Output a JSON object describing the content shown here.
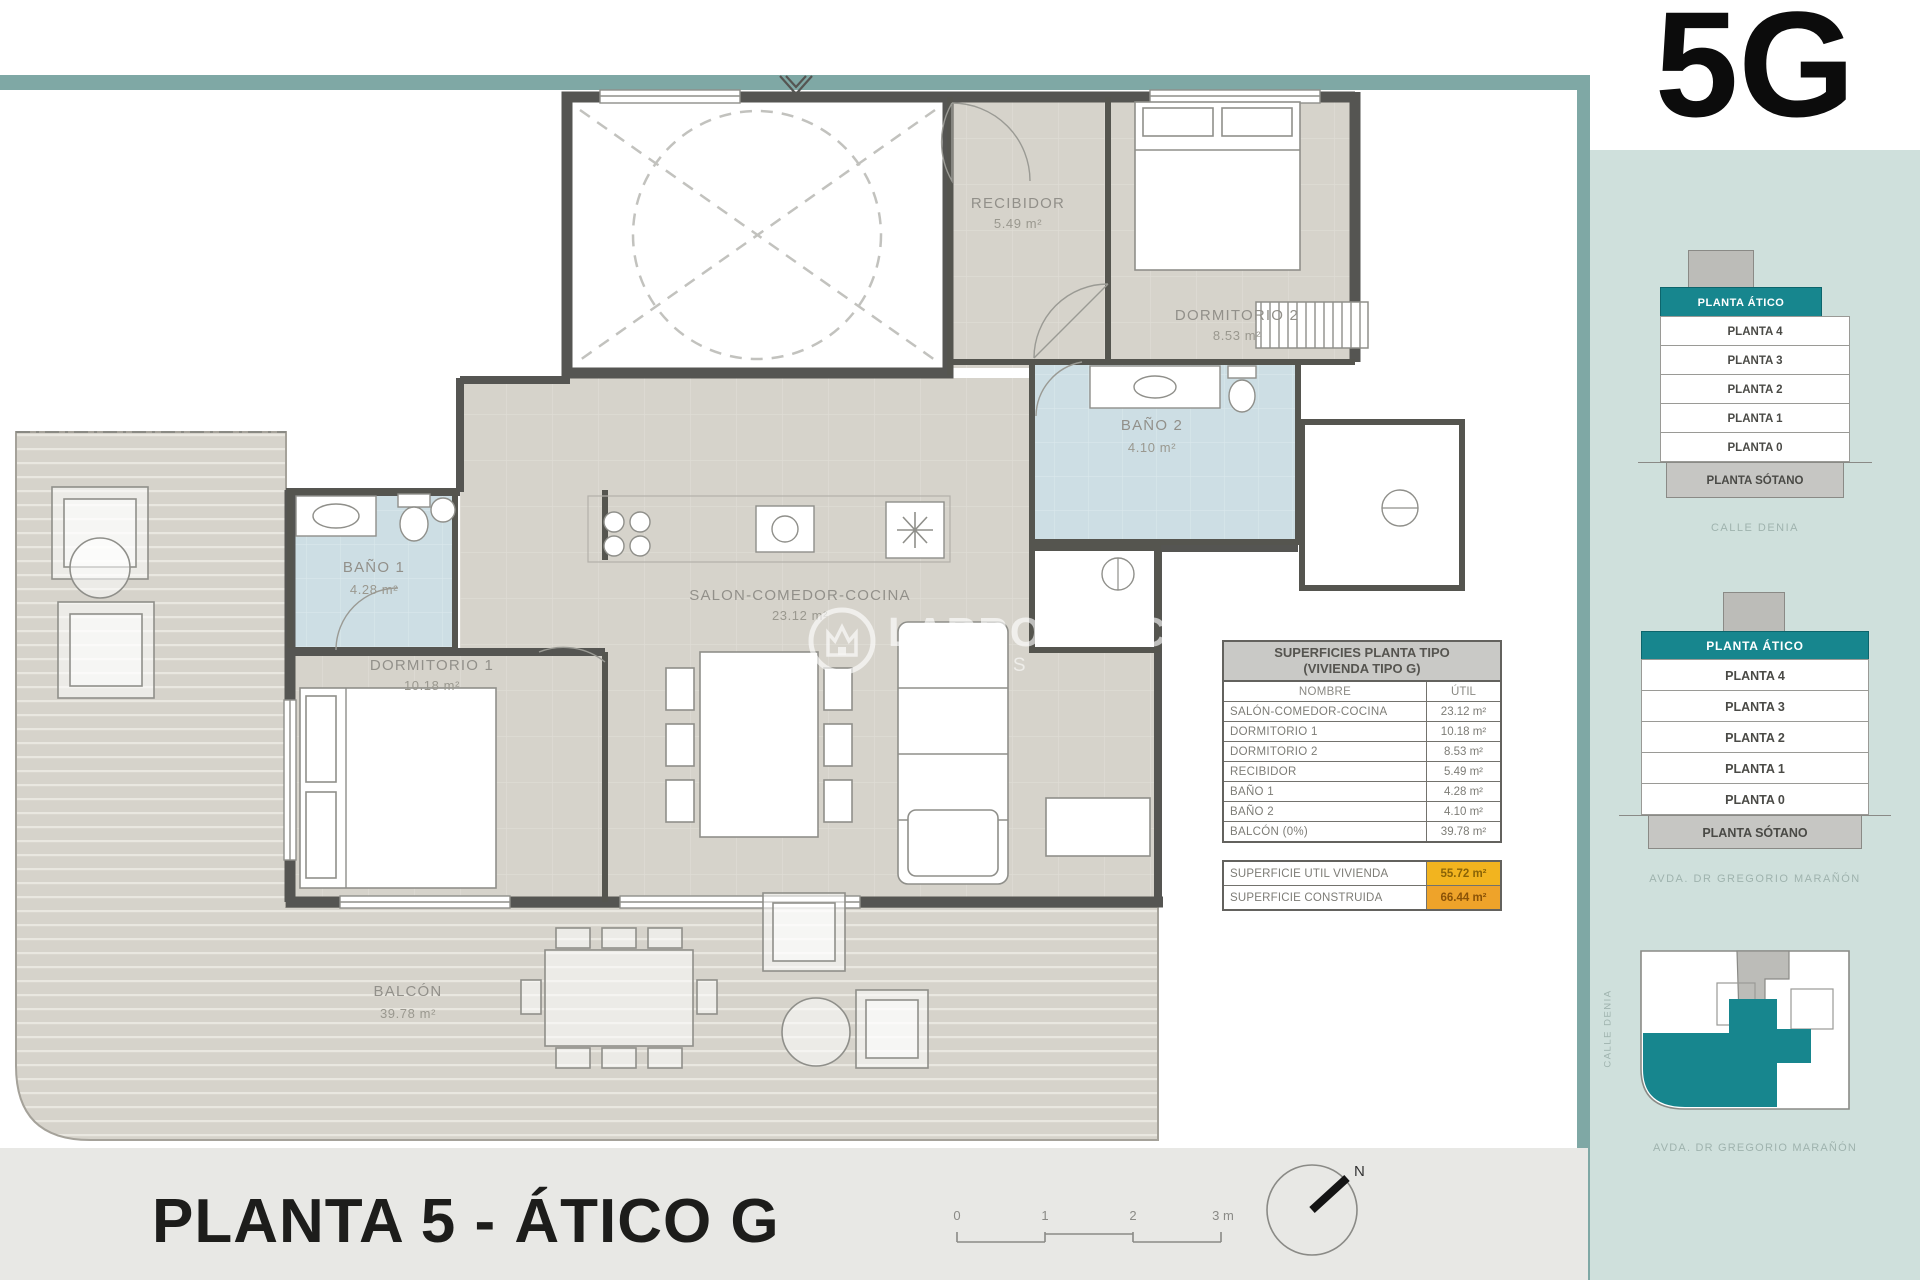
{
  "unit": "5G",
  "plan_title": "PLANTA 5 - ÁTICO G",
  "watermark": {
    "brand": "LARROSA&CO",
    "sub": "RTIES"
  },
  "colors": {
    "accent_teal": "#17868e",
    "frame_teal": "#7fa8a5",
    "sidebar_bg": "#cfe0dc",
    "highlight_yellow": "#f2b41f",
    "highlight_orange": "#eea32a",
    "bath_blue": "#cddee4",
    "floor_grey": "#d6d3cb"
  },
  "rooms": {
    "recibidor": {
      "name": "RECIBIDOR",
      "area": "5.49 m²"
    },
    "dormitorio2": {
      "name": "DORMITORIO 2",
      "area": "8.53 m²"
    },
    "bano2": {
      "name": "BAÑO 2",
      "area": "4.10 m²"
    },
    "bano1": {
      "name": "BAÑO 1",
      "area": "4.28 m²"
    },
    "dormitorio1": {
      "name": "DORMITORIO 1",
      "area": "10.18 m²"
    },
    "salon": {
      "name": "SALON-COMEDOR-COCINA",
      "area": "23.12 m²"
    },
    "balcon": {
      "name": "BALCÓN",
      "area": "39.78 m²"
    }
  },
  "areas_table": {
    "title_line1": "SUPERFICIES PLANTA TIPO",
    "title_line2": "(VIVIENDA TIPO G)",
    "col_name": "NOMBRE",
    "col_util": "ÚTIL",
    "rows": [
      {
        "name": "SALÓN-COMEDOR-COCINA",
        "util": "23.12 m²"
      },
      {
        "name": "DORMITORIO 1",
        "util": "10.18 m²"
      },
      {
        "name": "DORMITORIO 2",
        "util": "8.53 m²"
      },
      {
        "name": "RECIBIDOR",
        "util": "5.49 m²"
      },
      {
        "name": "BAÑO 1",
        "util": "4.28 m²"
      },
      {
        "name": "BAÑO 2",
        "util": "4.10 m²"
      },
      {
        "name": "BALCÓN (0%)",
        "util": "39.78 m²"
      }
    ]
  },
  "summary_table": {
    "rows": [
      {
        "name": "SUPERFICIE UTIL VIVIENDA",
        "value": "55.72 m²"
      },
      {
        "name": "SUPERFICIE CONSTRUIDA",
        "value": "66.44 m²"
      }
    ]
  },
  "scale_bar": {
    "labels": [
      "0",
      "1",
      "2",
      "3 m"
    ]
  },
  "compass": {
    "label": "N"
  },
  "sidebar": {
    "stack_levels": [
      "PLANTA ÁTICO",
      "PLANTA 4",
      "PLANTA 3",
      "PLANTA 2",
      "PLANTA 1",
      "PLANTA 0",
      "PLANTA SÓTANO"
    ],
    "stack1_caption": "CALLE DENIA",
    "stack2_caption": "AVDA. DR GREGORIO MARAÑÓN",
    "siteplan": {
      "left_label": "CALLE DENIA",
      "bottom_label": "AVDA. DR GREGORIO MARAÑÓN"
    }
  }
}
